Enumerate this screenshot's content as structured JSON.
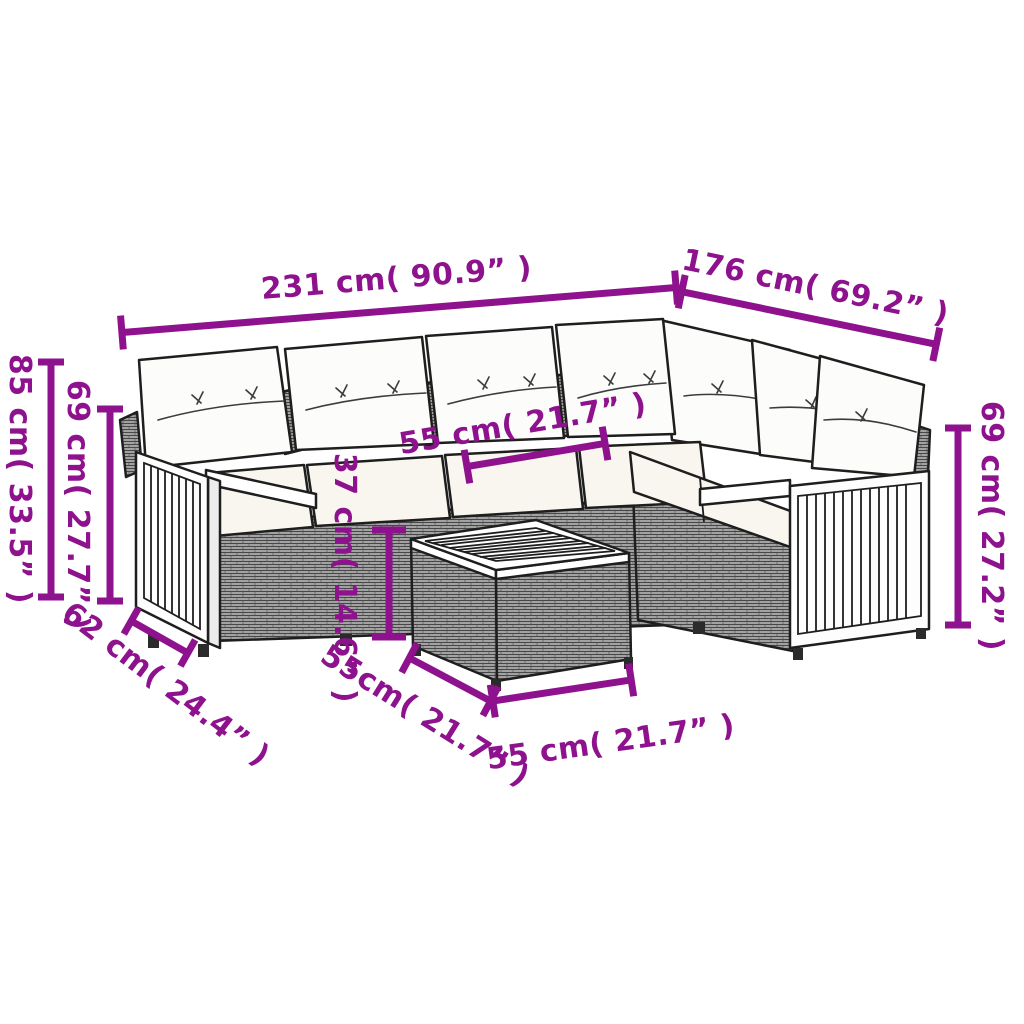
{
  "diagram": {
    "description": "L-shaped rattan garden lounge set with cushions and square coffee table, annotated dimension drawing",
    "background_color": "#ffffff",
    "accent_color": "#8E118D",
    "outline_color": "#1e1e1e",
    "rattan_color": "#919191",
    "cushion_color": "#fcfcfa",
    "seat_color": "#f8f6ef",
    "wood_color": "#fdfdfd"
  },
  "dimensions": {
    "sofa_length": {
      "label": "231 cm( 90.9” )"
    },
    "sofa_right_side": {
      "label": "176 cm( 69.2” )"
    },
    "back_height": {
      "label": "85 cm( 33.5” )"
    },
    "left_arm_height": {
      "label": "69 cm( 27.7” )"
    },
    "seat_depth": {
      "label": "62 cm( 24.4” )"
    },
    "seat_width": {
      "label": "55 cm( 21.7” )"
    },
    "table_height": {
      "label": "37 cm( 14.6” )"
    },
    "table_side": {
      "label": "55cm( 21.7” )"
    },
    "table_front": {
      "label": "55 cm( 21.7” )"
    },
    "right_arm_height": {
      "label": "69 cm( 27.2” )"
    }
  }
}
